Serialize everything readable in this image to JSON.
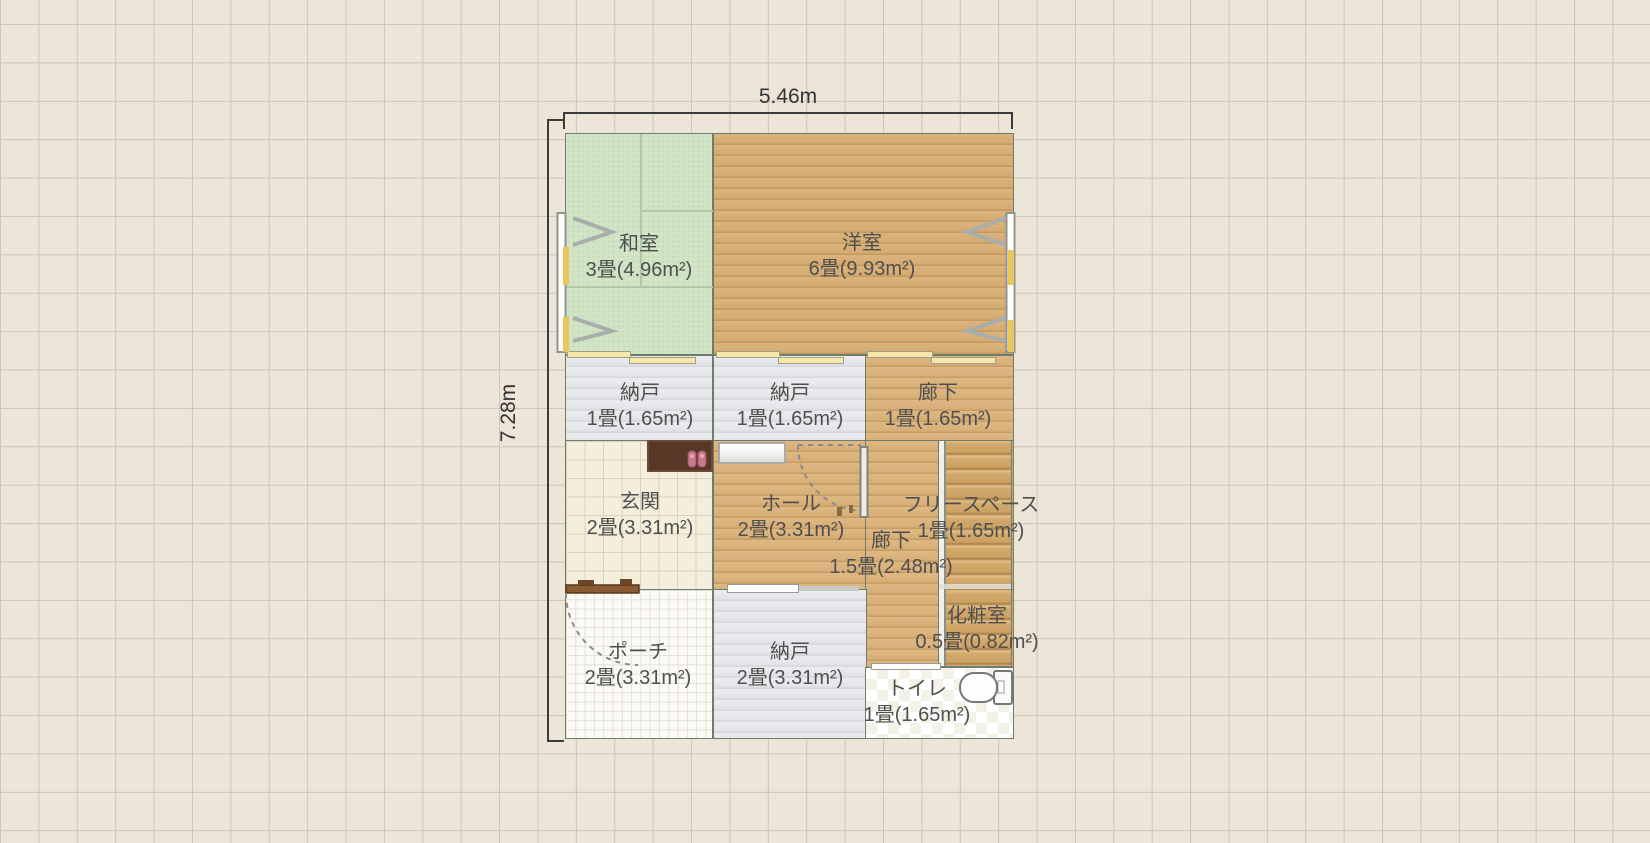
{
  "canvas": {
    "width_dim": "5.46m",
    "height_dim": "7.28m"
  },
  "rooms": [
    {
      "id": "washitsu",
      "name": "和室",
      "area": "3畳(4.96m²)"
    },
    {
      "id": "youshitsu",
      "name": "洋室",
      "area": "6畳(9.93m²)"
    },
    {
      "id": "nando-a",
      "name": "納戸",
      "area": "1畳(1.65m²)"
    },
    {
      "id": "nando-b",
      "name": "納戸",
      "area": "1畳(1.65m²)"
    },
    {
      "id": "rouka-a",
      "name": "廊下",
      "area": "1畳(1.65m²)"
    },
    {
      "id": "genkan",
      "name": "玄関",
      "area": "2畳(3.31m²)"
    },
    {
      "id": "hall",
      "name": "ホール",
      "area": "2畳(3.31m²)"
    },
    {
      "id": "rouka-b",
      "name": "廊下",
      "area": "1.5畳(2.48m²)"
    },
    {
      "id": "freespace",
      "name": "フリースペース",
      "area": "1畳(1.65m²)"
    },
    {
      "id": "keshoushitsu",
      "name": "化粧室",
      "area": "0.5畳(0.82m²)"
    },
    {
      "id": "porch",
      "name": "ポーチ",
      "area": "2畳(3.31m²)"
    },
    {
      "id": "nando-c",
      "name": "納戸",
      "area": "2畳(3.31m²)"
    },
    {
      "id": "toilet",
      "name": "トイレ",
      "area": "1畳(1.65m²)"
    }
  ],
  "palette": {
    "background": "#ece5d8",
    "grid_line": "#ccc5b8",
    "tatami_green": "#d2e4c6",
    "wood_floor": "#d9b179",
    "storage_gray": "#e6e8ea",
    "genkan_tile": "#f4eedd",
    "porch_tile": "#fbfaf5",
    "wall": "#4e5e50",
    "label_text": "#4f4f4f",
    "entry_door_brown": "#8a5a33",
    "mat_brown": "#573826",
    "slipper_pink": "#c9798c",
    "stair_tread": "#d2a86c",
    "sliding_door_cream": "#f6e8ab"
  }
}
